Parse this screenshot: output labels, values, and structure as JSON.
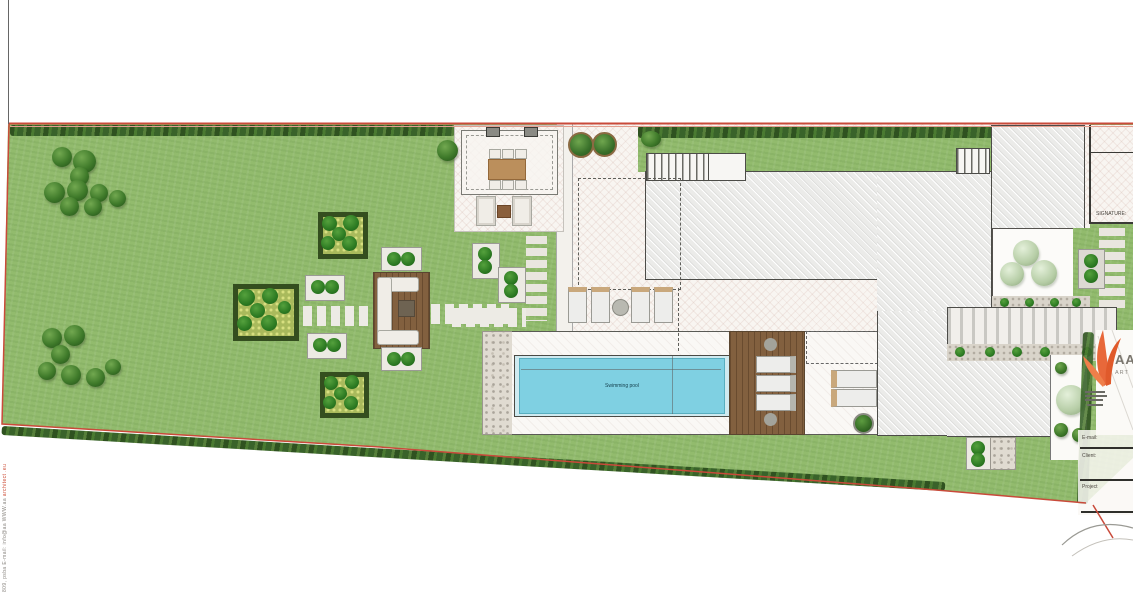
{
  "plan": {
    "pool": {
      "label": "Swimming pool",
      "water_color": "#7fd0e2"
    },
    "title_block": {
      "signature_label": "SIGNATURE:",
      "email_label": "E-mail:",
      "client_label": "Client:",
      "project_label": "Project"
    },
    "logo": {
      "letters": "AA",
      "subtext": "ART",
      "color": "#e8683a"
    },
    "left_margin": {
      "contact_gray": "809, psba   E-mail: info@aa   WWW.aa ",
      "contact_red": "architect .eu"
    },
    "colors": {
      "lawn": "#92bb6d",
      "hedge": "#3f6526",
      "paving": "#f8f5f1",
      "building": "#ebebe9",
      "wood_deck": "#82603f",
      "boundary_red": "#c94a3a",
      "pool_water": "#7fd0e2",
      "logo_orange": "#e8683a"
    }
  }
}
